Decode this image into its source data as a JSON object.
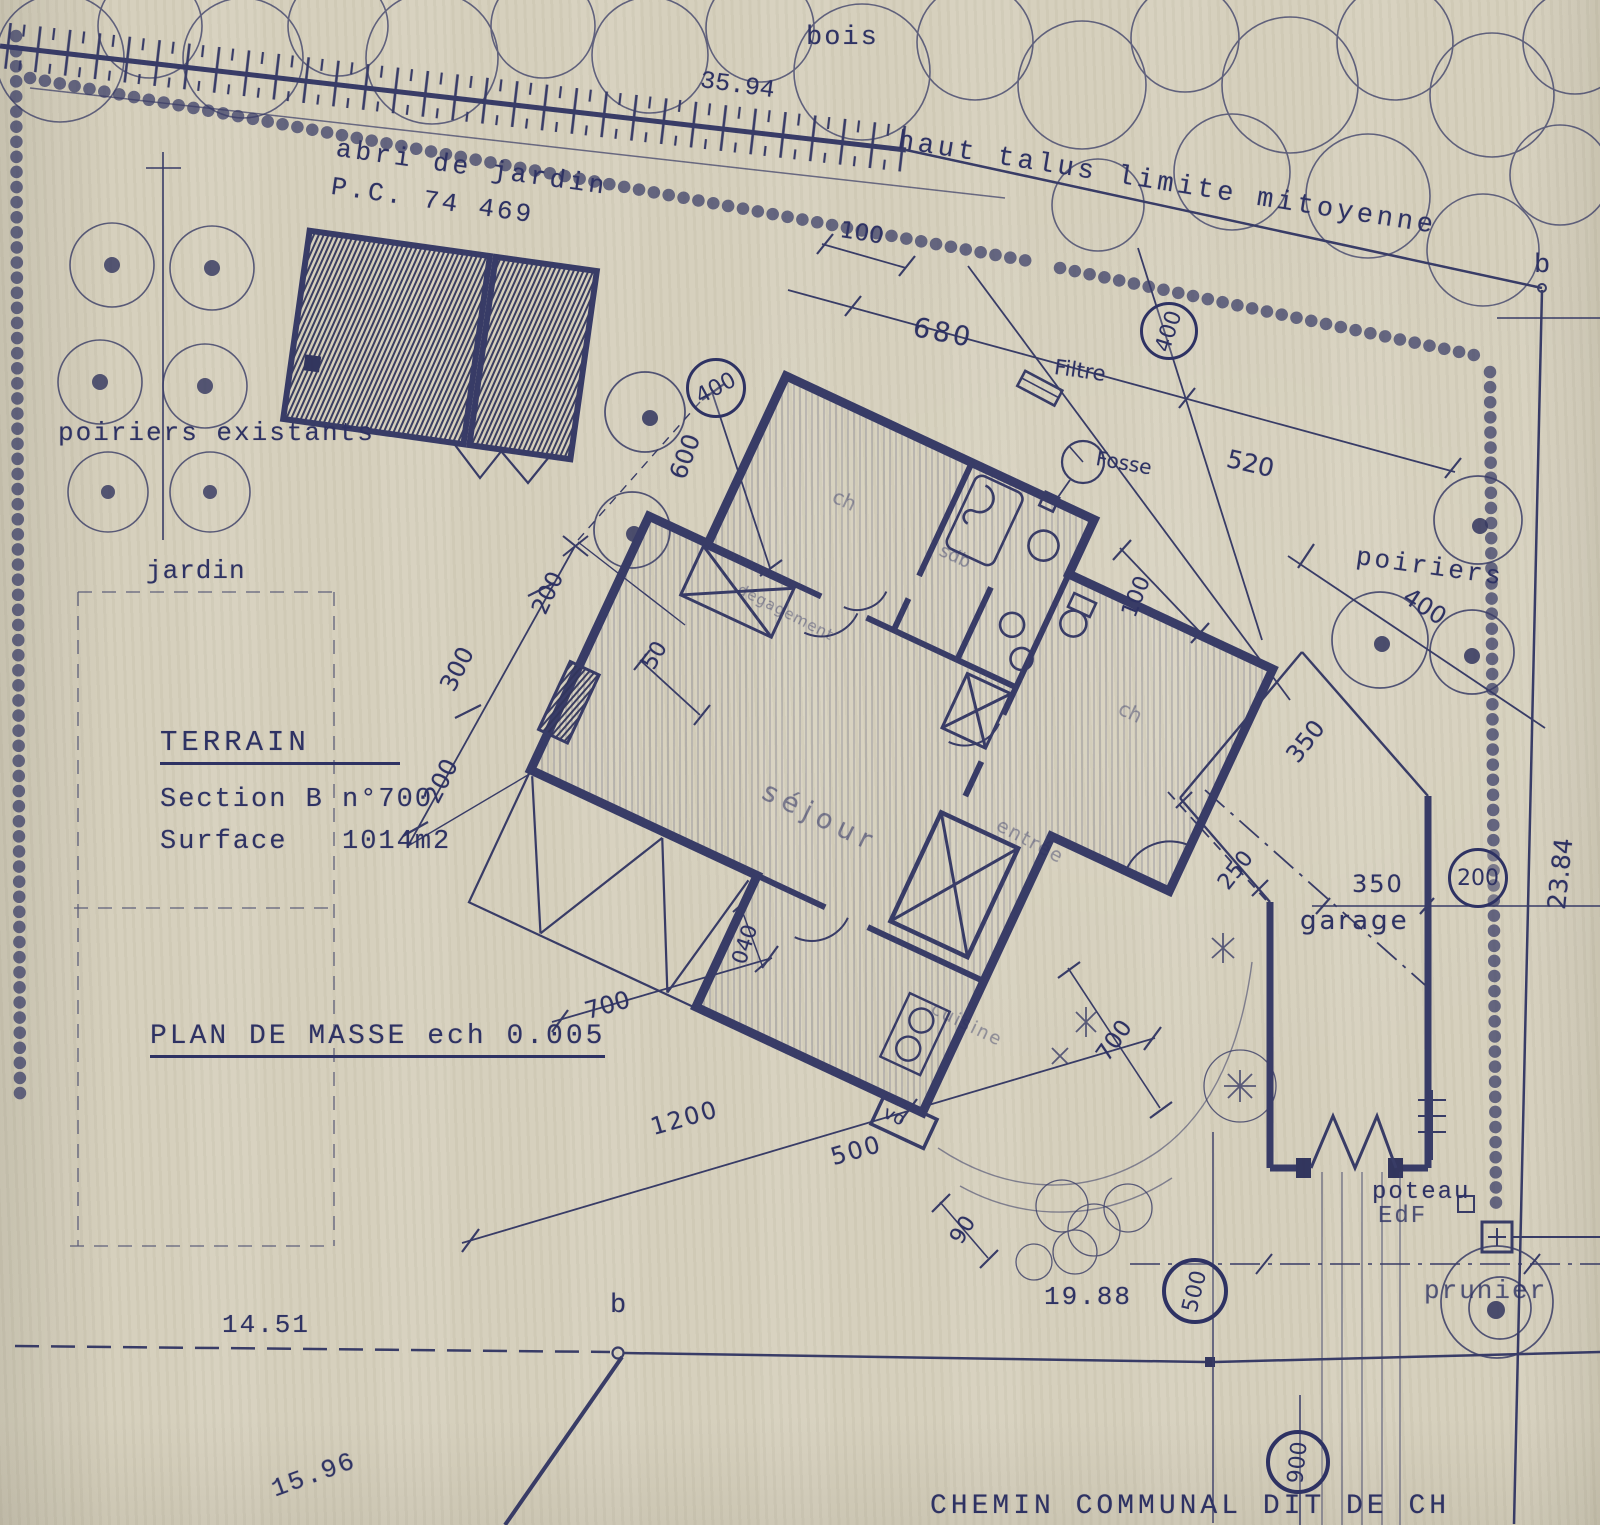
{
  "labels": {
    "bois": "bois",
    "haut_talus": "haut talus limite mitoyenne",
    "dim_35_94": "35.94",
    "abri_1": "abri de jardin",
    "abri_2": "P.C. 74 469",
    "poiriers_existants": "poiriers existants",
    "jardin": "jardin",
    "poiriers_right": "poiriers",
    "prunier": "prunier",
    "poteau": "poteau",
    "edf": "EdF",
    "chemin": "CHEMIN COMMUNAL DIT DE CH",
    "b_top": "b",
    "b_bottom": "b",
    "filtre": "Filtre",
    "fosse": "Fosse",
    "dim_14_51": "14.51",
    "dim_15_96": "15.96",
    "dim_19_88": "19.88",
    "dim_23_84": "23.84"
  },
  "terrain": {
    "title": "TERRAIN",
    "section": "Section B n°700",
    "surface": "Surface   1014m2"
  },
  "plan_title": "PLAN DE MASSE ech 0.005",
  "rooms": {
    "sejour": "séjour",
    "entree": "entrée",
    "cuisine": "cuisine",
    "ch1": "ch",
    "ch2": "ch",
    "sdb": "sdb",
    "degagement": "dégagement",
    "vo": "vo",
    "garage": "garage"
  },
  "dims": {
    "d100_top": "100",
    "d680": "680",
    "d400_top": "400",
    "d520": "520",
    "d400_left": "400",
    "d600": "600",
    "d200_up": "200",
    "d300": "300",
    "d200_low": "200",
    "d50": "50",
    "d100_right": "100",
    "d040": "040",
    "d350_diag": "350",
    "d250_diag": "250",
    "d350_garage": "350",
    "d200_circled": "200",
    "d700": "700",
    "d1200": "1200",
    "d500": "500",
    "d90": "90",
    "d700_diag": "700",
    "d500_circled": "500",
    "d900_circled": "900",
    "d400_poiriers": "400"
  }
}
